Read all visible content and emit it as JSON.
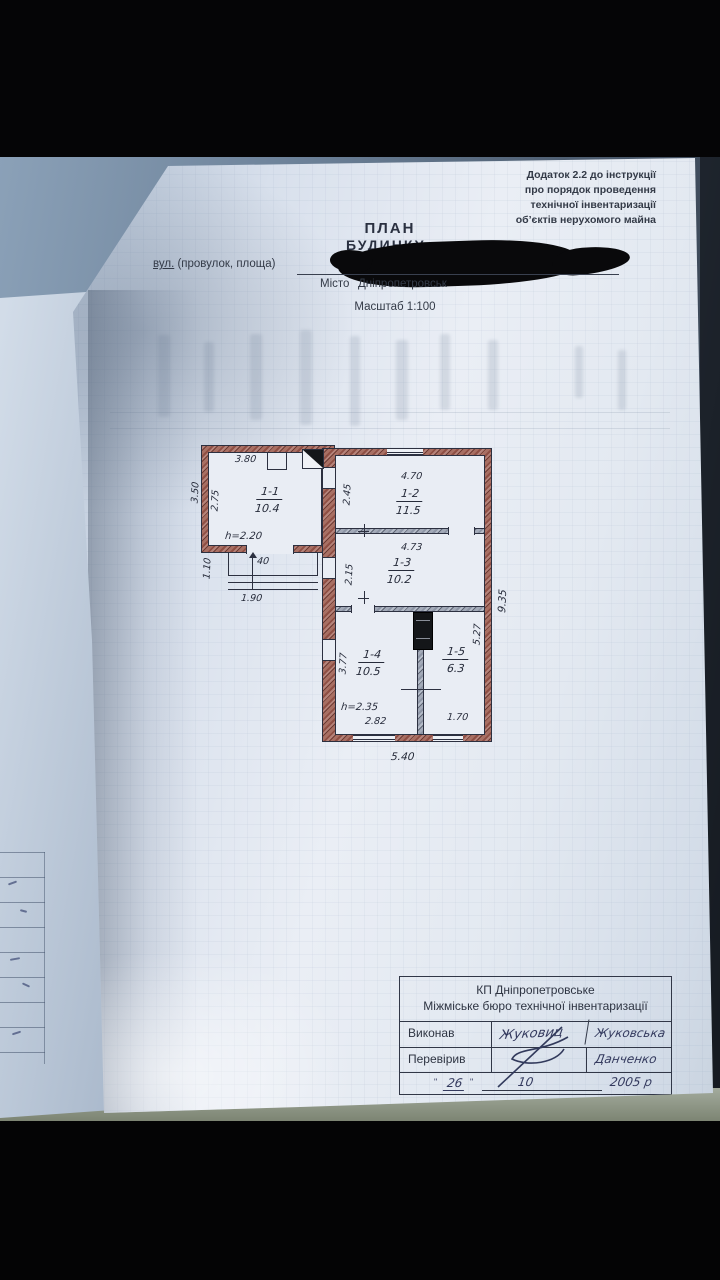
{
  "appendix_note": {
    "lines": [
      "Додаток 2.2 до інструкції",
      "про порядок проведення",
      "технічної інвентаризації",
      "об’єктів нерухомого майна"
    ]
  },
  "title_block": {
    "title": "ПЛАН",
    "subtitle": "БУДИНКУ",
    "address_label_street": "вул.",
    "address_label_rest": " (провулок, площа)",
    "city_label": "Місто",
    "city_value": "Дніпропетровськ",
    "scale": "Масштаб 1:100"
  },
  "plan": {
    "rooms": [
      {
        "id": "1-1",
        "area": "10.4"
      },
      {
        "id": "1-2",
        "area": "11.5"
      },
      {
        "id": "1-3",
        "area": "10.2"
      },
      {
        "id": "1-4",
        "area": "10.5"
      },
      {
        "id": "1-5",
        "area": "6.3"
      }
    ],
    "heights": {
      "room11": "h=2.20",
      "room14": "h=2.35"
    },
    "dims": {
      "r11_width": "3.80",
      "left_outer": "3.50",
      "r11_depth": "2.75",
      "porch_height": "1.10",
      "porch_step": "40",
      "porch_width": "1.90",
      "r12_width": "4.70",
      "r12_depth": "2.45",
      "r13_width": "4.73",
      "r13_depth": "2.15",
      "r14_depth": "3.77",
      "r15_depth": "5.27",
      "right_outer": "9.35",
      "r14_width": "2.82",
      "r15_width": "1.70",
      "bottom_outer": "5.40"
    }
  },
  "stamp_table": {
    "org_line1": "КП Дніпропетровське",
    "org_line2": "Міжміське бюро технічної інвентаризації",
    "rows": [
      {
        "label": "Виконав",
        "signature": "Жуковиц",
        "name": "Жуковська"
      },
      {
        "label": "Перевірив",
        "signature": "",
        "name": "Данченко"
      }
    ],
    "date": {
      "day": "26",
      "month": "10",
      "year": "2005 р"
    }
  }
}
